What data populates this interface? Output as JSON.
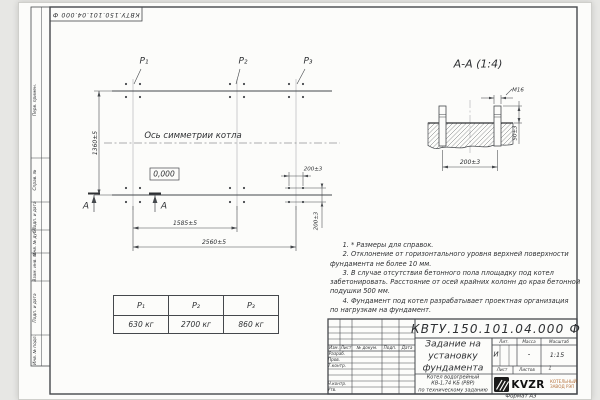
{
  "watermark": "kvzr.ru",
  "colors": {
    "line": "#45484c",
    "paper": "#fcfcfa",
    "logo_caption": "#b5703a"
  },
  "stamp_top": "КВТУ.150.101.04.000  Ф",
  "margin": {
    "perv": "Перв. примен.",
    "sprav": "Справ. №",
    "podp1": "Подп. и дата",
    "inv_dubl": "Инв. № дубл.",
    "vzam": "Взам. инв. №",
    "podp2": "Подп. и дата",
    "inv_podl": "Инв. № подл."
  },
  "plan": {
    "p1": "P₁",
    "p2": "P₂",
    "p3": "P₃",
    "axis": "Ось симметрии котла",
    "elevation": "0,000",
    "section_letter": "А",
    "dim_height": "1360±5",
    "dim_span": "1585±5",
    "dim_total": "2560±5",
    "dim_bolt_x": "200±3",
    "dim_bolt_y": "200±3"
  },
  "section": {
    "title": "А-А (1:4)",
    "bolt": "М16",
    "dim_width": "200±3",
    "dim_height": "50±3"
  },
  "loads": {
    "headers": [
      "P₁",
      "P₂",
      "P₃"
    ],
    "values": [
      "630 кг",
      "2700 кг",
      "860 кг"
    ]
  },
  "notes": "      1. * Размеры для справок.\n      2. Отклонение от горизонтального уровня верхней поверхности\nфундамента не более 10 мм.\n      3. В случае отсутствия бетонного пола площадку под котел\nзабетонировать. Расстояние от осей крайних колонн до края бетонной\nподушки 500 мм.\n      4. Фундамент под котел разрабатывает проектная организация\nпо нагрузкам на фундамент.",
  "tb": {
    "doc": "КВТУ.150.101.04.000  Ф",
    "title": "Задание на\nустановку\nфундамента",
    "object": "Котел водогрейный\nКВ-1,74 КБ (РВР)\nпо техническому заданию",
    "col_izm": "Изм.",
    "col_list": "Лист",
    "col_doc": "№ докум.",
    "col_podp": "Подп.",
    "col_data": "Дата",
    "razrab": "Разраб.",
    "prov": "Пров.",
    "tkontr": "Т.контр.",
    "nkontr": "Н.контр.",
    "utv": "Утв.",
    "lit_label": "Лит.",
    "lit": "И",
    "mass_label": "Масса",
    "mass": "-",
    "scale_label": "Масштаб",
    "scale": "1:15",
    "list_label": "Лист",
    "listov_label": "Листов",
    "listov": "1",
    "logo": "KVZR",
    "logo_caption": "КОТЕЛЬНЫЙ\nЗАВОД РЭП",
    "format": "Формат А3"
  }
}
